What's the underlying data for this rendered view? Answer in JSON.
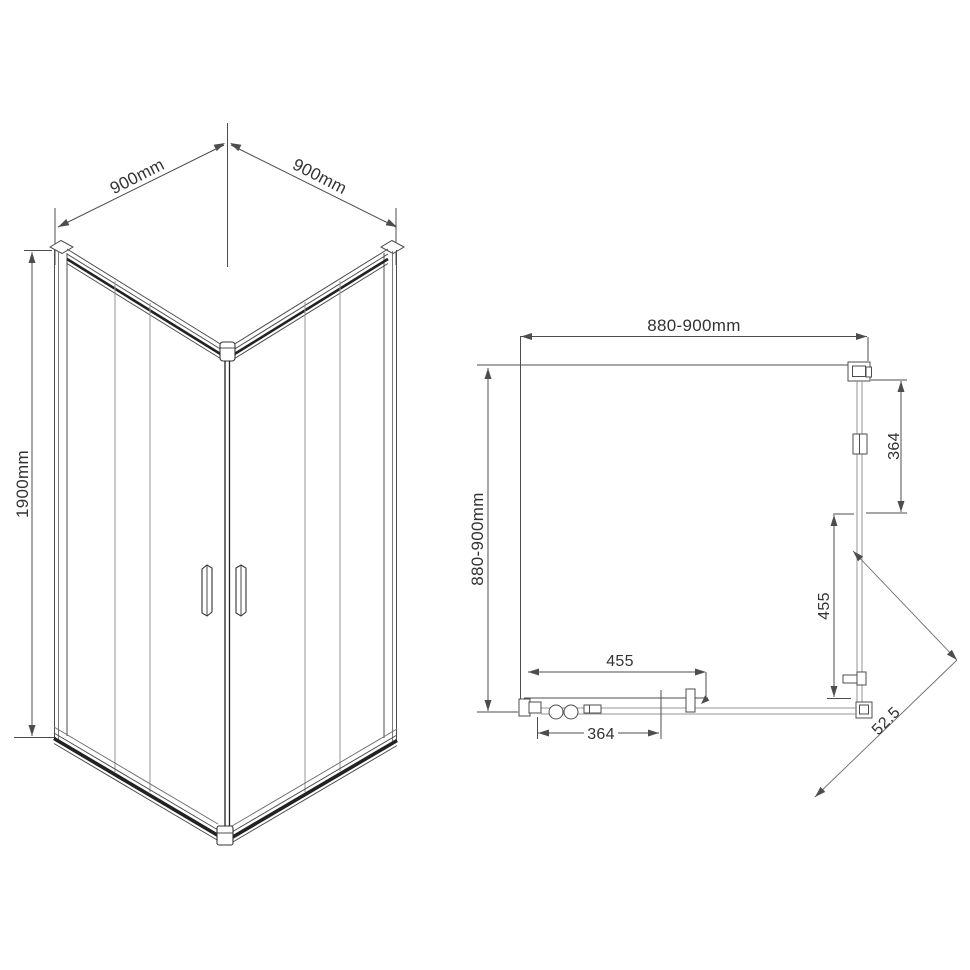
{
  "colors": {
    "background": "#ffffff",
    "drawing_line": "#4d4d4d",
    "dark_profile_line": "#222222",
    "glass_line": "#949494",
    "text": "#333333"
  },
  "isometric_view": {
    "top_width_left_label": "900mm",
    "top_width_right_label": "900mm",
    "height_label": "1900mm"
  },
  "plan_view": {
    "overall_width_label": "880-900mm",
    "overall_depth_label": "880-900mm",
    "side_fixed_panel_label": "364",
    "side_door_opening_label": "455",
    "front_door_opening_label": "455",
    "front_fixed_panel_label": "364",
    "corner_entry_label": "52.5"
  }
}
